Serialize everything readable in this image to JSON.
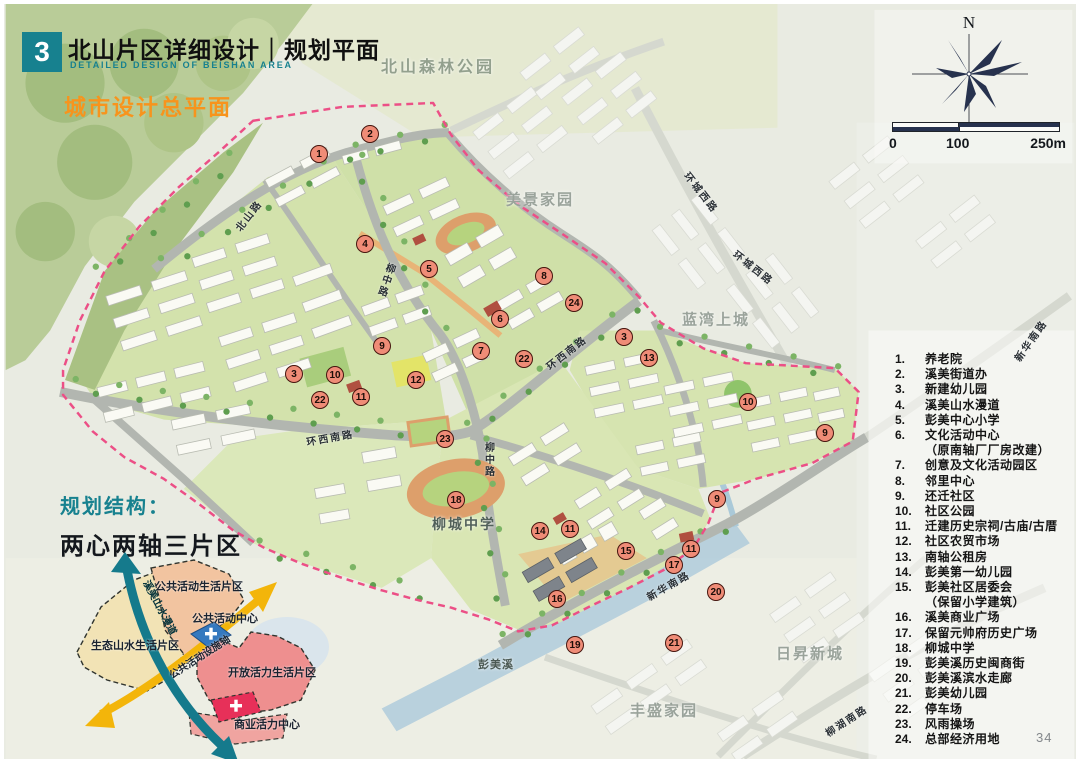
{
  "header": {
    "chapter_number": "3",
    "title": "北山片区详细设计｜规划平面",
    "subtitle_en": "DETAILED DESIGN OF BEISHAN AREA",
    "section_title": "城市设计总平面"
  },
  "compass": {
    "north_label": "N"
  },
  "scale_bar": {
    "ticks": [
      "0",
      "100",
      "250m"
    ]
  },
  "legend": {
    "items": [
      {
        "num": "1.",
        "label": "养老院"
      },
      {
        "num": "2.",
        "label": "溪美街道办"
      },
      {
        "num": "3.",
        "label": "新建幼儿园"
      },
      {
        "num": "4.",
        "label": "溪美山水漫道"
      },
      {
        "num": "5.",
        "label": "彭美中心小学"
      },
      {
        "num": "6.",
        "label": "文化活动中心",
        "label2": "（原南轴厂厂房改建）"
      },
      {
        "num": "7.",
        "label": "创意及文化活动园区"
      },
      {
        "num": "8.",
        "label": "邻里中心"
      },
      {
        "num": "9.",
        "label": "还迁社区"
      },
      {
        "num": "10.",
        "label": "社区公园"
      },
      {
        "num": "11.",
        "label": "迁建历史宗祠/古庙/古厝"
      },
      {
        "num": "12.",
        "label": "社区农贸市场"
      },
      {
        "num": "13.",
        "label": "南轴公租房"
      },
      {
        "num": "14.",
        "label": "彭美第一幼儿园"
      },
      {
        "num": "15.",
        "label": "彭美社区居委会",
        "label2": "（保留小学建筑）"
      },
      {
        "num": "16.",
        "label": "溪美商业广场"
      },
      {
        "num": "17.",
        "label": "保留元帅府历史广场"
      },
      {
        "num": "18.",
        "label": "柳城中学"
      },
      {
        "num": "19.",
        "label": "彭美溪历史闽商街"
      },
      {
        "num": "20.",
        "label": "彭美溪滨水走廊"
      },
      {
        "num": "21.",
        "label": "彭美幼儿园"
      },
      {
        "num": "22.",
        "label": "停车场"
      },
      {
        "num": "23.",
        "label": "风雨操场"
      },
      {
        "num": "24.",
        "label": "总部经济用地"
      }
    ]
  },
  "map": {
    "area_labels": [
      {
        "text": "北山森林公园",
        "x": 430,
        "y": 57,
        "size": 16,
        "color": "#93a08e",
        "ls": 3
      },
      {
        "text": "美景家园",
        "x": 532,
        "y": 191,
        "size": 15,
        "color": "#9aa39b",
        "ls": 2
      },
      {
        "text": "蓝湾上城",
        "x": 708,
        "y": 311,
        "size": 15,
        "color": "#9aa39b",
        "ls": 2
      },
      {
        "text": "日昇新城",
        "x": 802,
        "y": 645,
        "size": 15,
        "color": "#9aa39b",
        "ls": 2
      },
      {
        "text": "丰盛家园",
        "x": 656,
        "y": 702,
        "size": 15,
        "color": "#9aa39b",
        "ls": 2
      },
      {
        "text": "柳城中学",
        "x": 456,
        "y": 516,
        "size": 14,
        "color": "#51605a",
        "ls": 2
      },
      {
        "text": "彭美溪",
        "x": 488,
        "y": 656,
        "size": 11,
        "color": "#4c5a54",
        "ls": 1
      }
    ],
    "road_labels": [
      {
        "text": "北山路",
        "x": 240,
        "y": 207,
        "angle": -52
      },
      {
        "text": "柳中路",
        "x": 377,
        "y": 272,
        "angle": 18,
        "vertical": true
      },
      {
        "text": "环西南路",
        "x": 322,
        "y": 429,
        "angle": -10
      },
      {
        "text": "环西南路",
        "x": 558,
        "y": 344,
        "angle": -38
      },
      {
        "text": "柳中路",
        "x": 480,
        "y": 452,
        "angle": 0,
        "vertical": true
      },
      {
        "text": "新华南路",
        "x": 660,
        "y": 577,
        "angle": -30
      },
      {
        "text": "环城西路",
        "x": 694,
        "y": 184,
        "angle": 52
      },
      {
        "text": "环城西路",
        "x": 746,
        "y": 259,
        "angle": 38
      },
      {
        "text": "新华南路",
        "x": 1022,
        "y": 332,
        "angle": -55
      },
      {
        "text": "柳湖南路",
        "x": 838,
        "y": 712,
        "angle": -33
      }
    ],
    "markers": [
      {
        "n": "1",
        "x": 311,
        "y": 146
      },
      {
        "n": "2",
        "x": 362,
        "y": 126
      },
      {
        "n": "4",
        "x": 357,
        "y": 236
      },
      {
        "n": "5",
        "x": 421,
        "y": 261
      },
      {
        "n": "8",
        "x": 536,
        "y": 268
      },
      {
        "n": "24",
        "x": 566,
        "y": 295
      },
      {
        "n": "6",
        "x": 492,
        "y": 311
      },
      {
        "n": "3",
        "x": 616,
        "y": 329
      },
      {
        "n": "13",
        "x": 641,
        "y": 350
      },
      {
        "n": "9",
        "x": 374,
        "y": 338
      },
      {
        "n": "7",
        "x": 473,
        "y": 343
      },
      {
        "n": "22",
        "x": 516,
        "y": 351
      },
      {
        "n": "3",
        "x": 286,
        "y": 366
      },
      {
        "n": "10",
        "x": 327,
        "y": 367
      },
      {
        "n": "12",
        "x": 408,
        "y": 372
      },
      {
        "n": "11",
        "x": 353,
        "y": 389
      },
      {
        "n": "22",
        "x": 312,
        "y": 392
      },
      {
        "n": "10",
        "x": 740,
        "y": 394
      },
      {
        "n": "9",
        "x": 817,
        "y": 425
      },
      {
        "n": "23",
        "x": 437,
        "y": 431
      },
      {
        "n": "18",
        "x": 448,
        "y": 492
      },
      {
        "n": "9",
        "x": 709,
        "y": 491
      },
      {
        "n": "14",
        "x": 532,
        "y": 523
      },
      {
        "n": "11",
        "x": 562,
        "y": 521
      },
      {
        "n": "15",
        "x": 618,
        "y": 543
      },
      {
        "n": "11",
        "x": 683,
        "y": 541
      },
      {
        "n": "17",
        "x": 666,
        "y": 557
      },
      {
        "n": "16",
        "x": 549,
        "y": 591
      },
      {
        "n": "20",
        "x": 708,
        "y": 584
      },
      {
        "n": "19",
        "x": 567,
        "y": 637
      },
      {
        "n": "21",
        "x": 666,
        "y": 635
      }
    ]
  },
  "structure": {
    "heading": "规划结构：",
    "subheading": "两心两轴三片区",
    "labels": {
      "zone_public": "公共活动生活片区",
      "zone_eco": "生态山水生活片区",
      "zone_vitality": "开放活力生活片区",
      "center_public": "公共活动中心",
      "center_commercial": "商业活力中心",
      "axis_teal": "溪美山水漫道",
      "axis_yellow": "公共活动设施轴"
    }
  },
  "page_number": "34",
  "colors": {
    "accent_teal": "#17818f",
    "accent_orange": "#f7941d",
    "boundary_pink": "#ec4f86",
    "marker_fill": "#ef8c77",
    "compass_navy": "#27324e"
  }
}
